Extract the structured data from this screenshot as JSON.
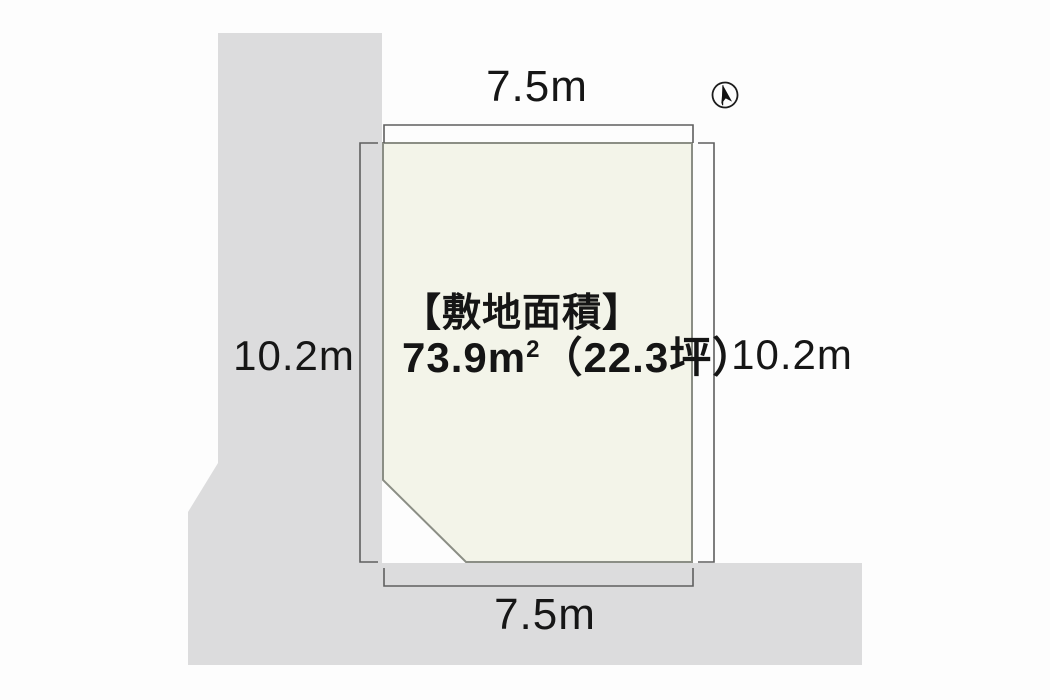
{
  "diagram": {
    "kind": "land-plot-site-diagram",
    "dimensions": {
      "top_width_label": "7.5m",
      "bottom_width_label": "7.5m",
      "left_depth_label": "10.2m",
      "right_depth_label": "10.2m"
    },
    "site_area": {
      "heading": "【敷地面積】",
      "value_main": "73.9m",
      "value_sup": "2",
      "value_rest": "（22.3坪）"
    },
    "compass": {
      "name": "north-arrow"
    },
    "colors": {
      "background": "#fdfdfd",
      "road_fill": "#dcdcdd",
      "plot_fill": "#f3f4e9",
      "plot_border": "#8b8e85",
      "dimension_line": "#5f5f5f",
      "text": "#161616",
      "compass_ink": "#1c1c1c"
    }
  }
}
